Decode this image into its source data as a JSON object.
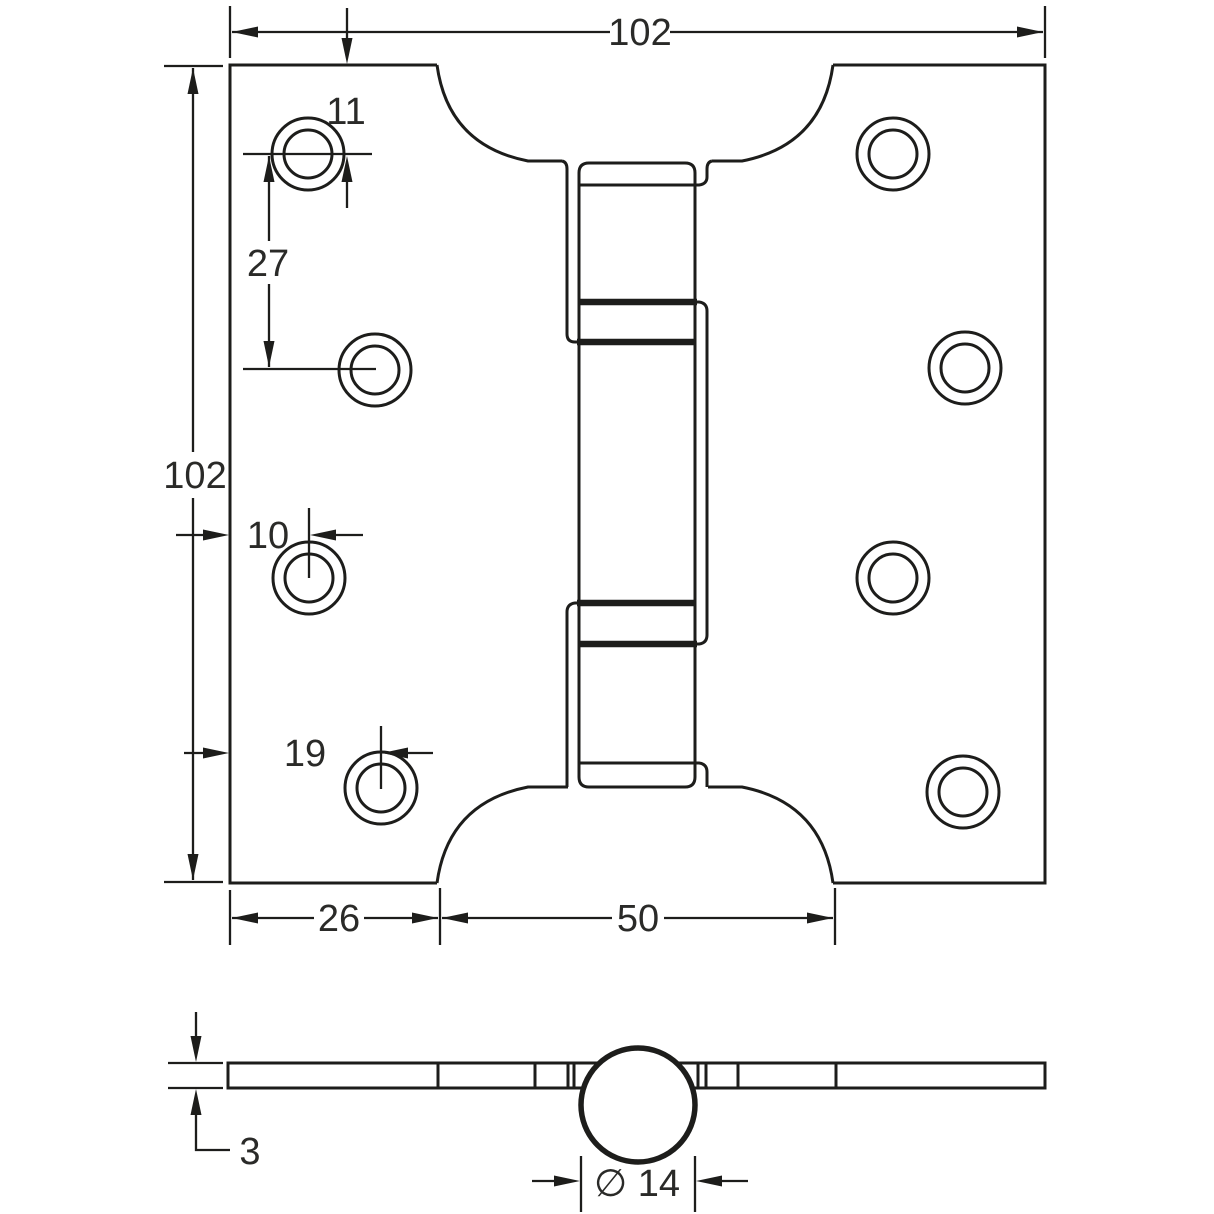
{
  "drawing": {
    "ink_color": "#1d1d1b",
    "background_color": "#ffffff",
    "dimensions": {
      "overall_width": "102",
      "overall_height": "102",
      "top_hole_offset": "11",
      "hole_pitch": "27",
      "hole_edge_offset_small": "10",
      "hole_edge_offset_large": "19",
      "leaf_flat_width": "26",
      "cutout_span": "50",
      "leaf_thickness": "3",
      "knuckle_diameter": "∅ 14"
    }
  }
}
